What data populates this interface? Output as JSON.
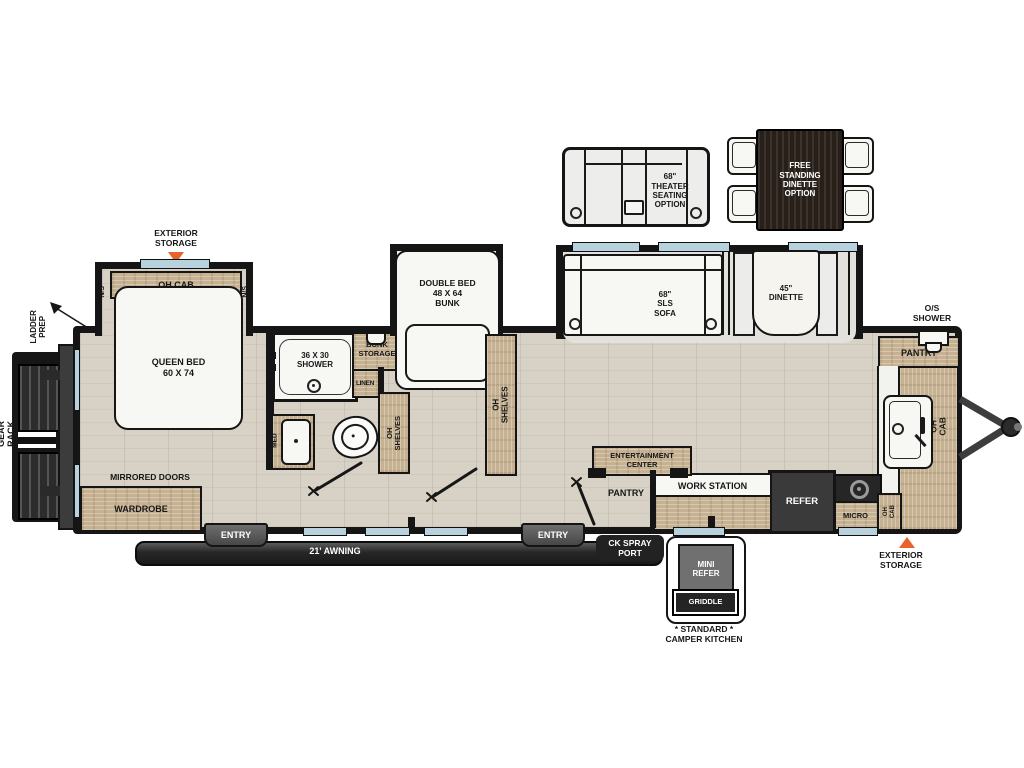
{
  "colors": {
    "accent_orange": "#e8632c",
    "wall_black": "#151515",
    "cabinet_wood": "#c6b292",
    "floor_beige": "#d8d2c6",
    "window_blue": "#b7d2dc",
    "appliance_dark": "#3a3a3a"
  },
  "options": {
    "theater_label": "68\"\nTHEATER\nSEATING\nOPTION",
    "dinette_label": "FREE\nSTANDING\nDINETTE\nOPTION"
  },
  "exterior": {
    "storage_top": "EXTERIOR\nSTORAGE",
    "storage_bottom": "EXTERIOR\nSTORAGE",
    "ladder_prep": "LADDER\nPREP",
    "gear_rack": "GEAR RACK",
    "awning": "21' AWNING",
    "ck_spray_port": "CK SPRAY\nPORT",
    "entry_left": "ENTRY",
    "entry_right": "ENTRY",
    "os_shower": "O/S\nSHOWER"
  },
  "bedroom": {
    "queen_bed": "QUEEN BED\n60 X 74",
    "oh_cab": "OH CAB",
    "ns_left": "N/S",
    "ns_right": "N/S",
    "wardrobe": "WARDROBE",
    "mirrored_doors": "MIRRORED DOORS"
  },
  "bathroom": {
    "shower": "36 X 30\nSHOWER",
    "bunk_storage": "BUNK\nSTORAGE",
    "linen": "LINEN",
    "med": "MED"
  },
  "bunk_room": {
    "double_bed": "DOUBLE BED\n48 X 64\nBUNK",
    "oh_shelves_left": "OH SHELVES",
    "oh_shelves_right": "OH SHELVES"
  },
  "living": {
    "sofa": "68\"\nSLS\nSOFA",
    "dinette": "45\"\nDINETTE",
    "entertainment_center": "ENTERTAINMENT\nCENTER",
    "pantry_rear": "PANTRY",
    "work_station": "WORK STATION",
    "refer": "REFER"
  },
  "kitchen": {
    "pantry_front": "PANTRY",
    "oh_cab_right": "OH CAB",
    "micro": "MICRO",
    "oh_cab_small": "OH CAB"
  },
  "camper_kitchen": {
    "mini_refer": "MINI\nREFER",
    "griddle": "GRIDDLE",
    "caption": "* STANDARD *\nCAMPER KITCHEN"
  }
}
